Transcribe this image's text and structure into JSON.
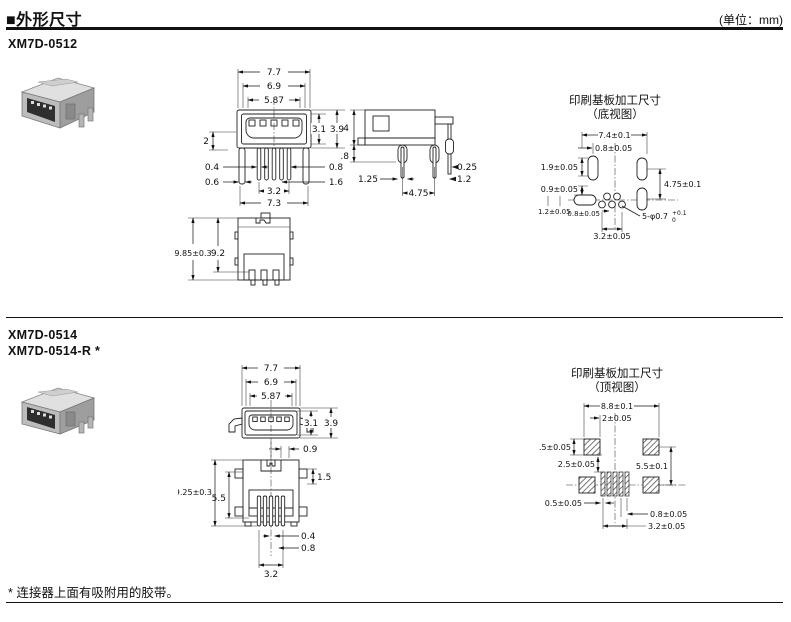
{
  "header": {
    "title": "■外形尺寸",
    "unit": "(单位：mm)"
  },
  "sections": [
    {
      "models": [
        "XM7D-0512"
      ],
      "pcb_title": "印刷基板加工尺寸",
      "pcb_subtitle": "（底视图）",
      "front": {
        "w1": "7.7",
        "w2": "6.9",
        "w3": "5.87",
        "h1": "3.1",
        "h2": "3.9",
        "left2": "2",
        "l04": "0.4",
        "l06": "0.6",
        "r08": "0.8",
        "r16": "1.6",
        "b32": "3.2",
        "b73": "7.3"
      },
      "side": {
        "h4": "4",
        "h18": "1.8",
        "r025": "0.25",
        "r12": "1.2",
        "b125": "1.25",
        "b475": "4.75"
      },
      "bottom": {
        "h985": "9.85±0.3",
        "h92": "9.2"
      },
      "pcb": {
        "w74": "7.4±0.1",
        "o08": "0.8±0.05",
        "l19": "1.9±0.05",
        "l09": "0.9±0.05",
        "r475": "4.75±0.1",
        "l12": "1.2±0.05",
        "b08": "0.8±0.05",
        "b32": "3.2±0.05",
        "holes": "5-φ0.7",
        "tol_plus": "+0.1",
        "tol_zero": "0"
      }
    },
    {
      "models": [
        "XM7D-0514",
        "XM7D-0514-R *"
      ],
      "pcb_title": "印刷基板加工尺寸",
      "pcb_subtitle": "（顶视图）",
      "front": {
        "w1": "7.7",
        "w2": "6.9",
        "w3": "5.87",
        "h1": "3.1",
        "h2": "3.9"
      },
      "bottom": {
        "t09": "0.9",
        "r15": "1.5",
        "h925": "9.25±0.3",
        "h55": "5.5",
        "r04": "0.4",
        "r08": "0.8",
        "b32": "3.2"
      },
      "pcb": {
        "w88": "8.8±0.1",
        "o2": "2±0.05",
        "l25": "2.5±0.05",
        "i25": "2.5±0.05",
        "r55": "5.5±0.1",
        "l05": "0.5±0.05",
        "b08": "0.8±0.05",
        "b32": "3.2±0.05"
      }
    }
  ],
  "footnote": "* 连接器上面有吸附用的胶带。"
}
